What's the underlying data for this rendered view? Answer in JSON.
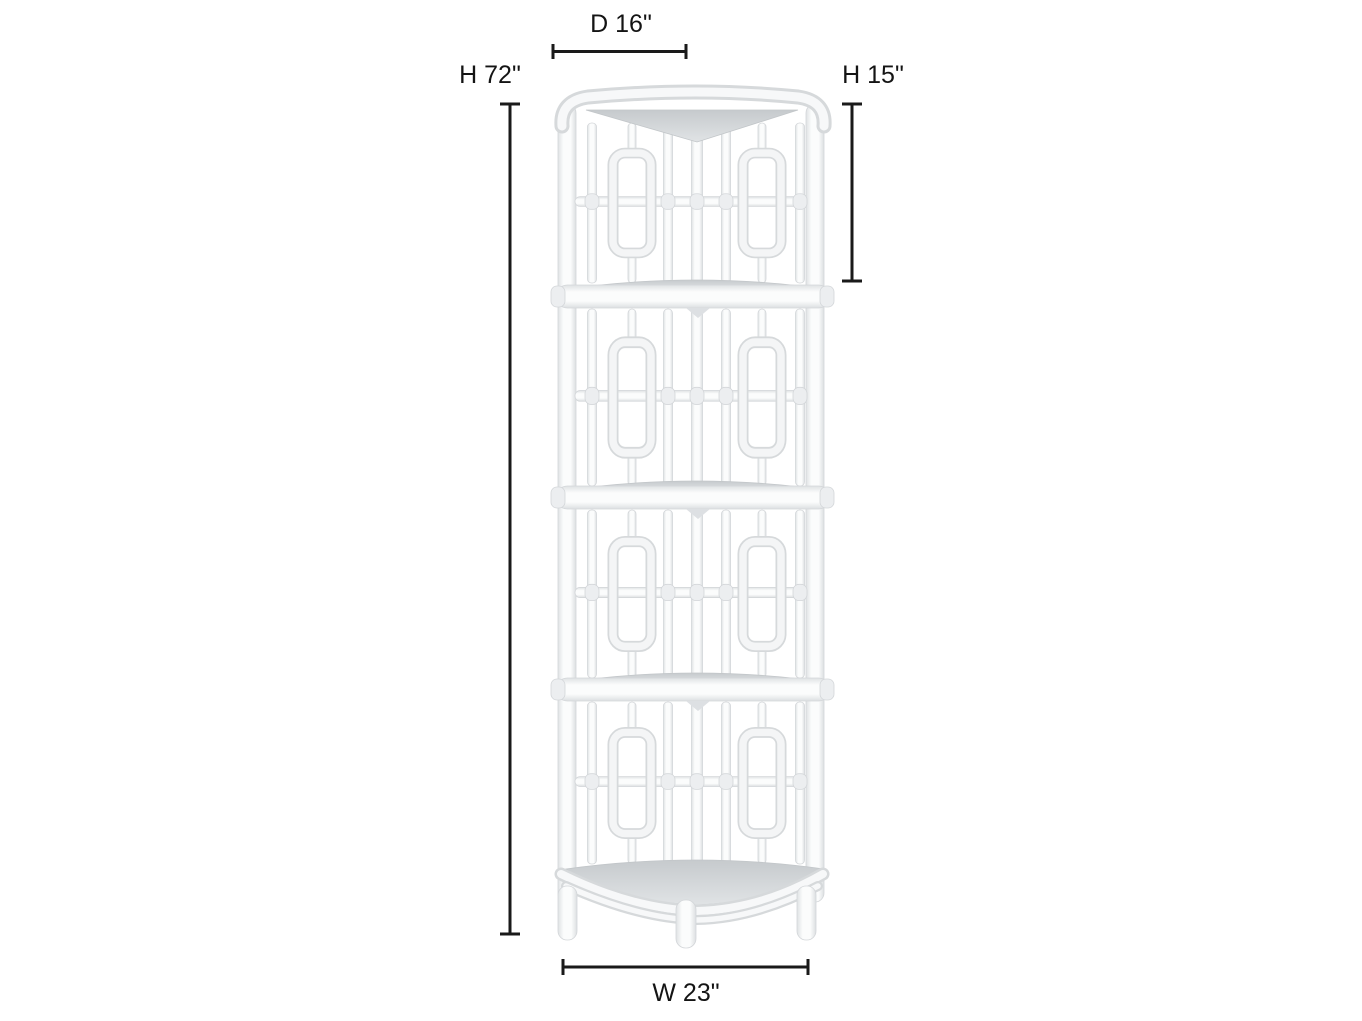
{
  "illustration": {
    "subject": "white rattan corner etagere with fretwork lattice panels",
    "shelf_count": 5
  },
  "annotations": {
    "depth": "D 16\"",
    "overall_height": "H 72\"",
    "top_section_height": "H 15\"",
    "width": "W 23\""
  },
  "colors": {
    "background": "#ffffff",
    "dimension_lines": "#1a1a1a",
    "label_text": "#141414",
    "furniture_white": "#f7f8f9",
    "furniture_outline": "#d6d9db",
    "shelf_surface": "#cdd1d4"
  }
}
